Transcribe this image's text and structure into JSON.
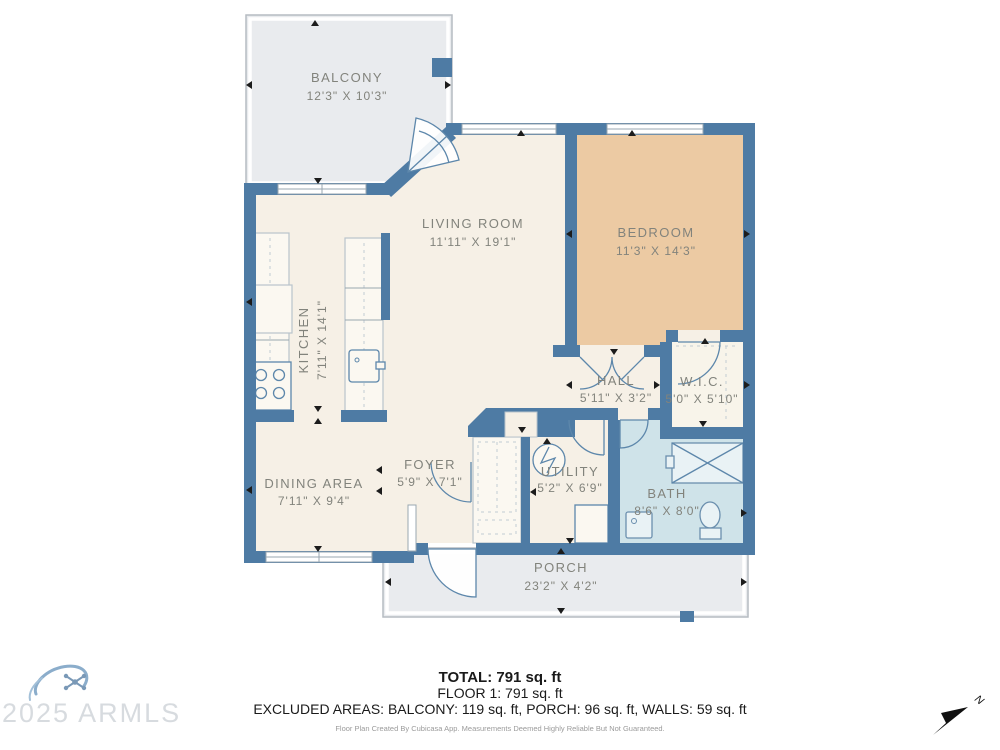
{
  "colors": {
    "wall": "#4e7ba4",
    "floor": "#f6f0e6",
    "bedroom": "#eccaa3",
    "bath": "#cfe3e9",
    "outdoor": "#e9ebee",
    "label": "#82837c"
  },
  "floor_plan": {
    "rooms": [
      {
        "name": "BALCONY",
        "dimensions": "12'3\" X 10'3\""
      },
      {
        "name": "LIVING ROOM",
        "dimensions": "11'11\" X 19'1\""
      },
      {
        "name": "KITCHEN",
        "dimensions": "7'11\" X 14'1\""
      },
      {
        "name": "BEDROOM",
        "dimensions": "11'3\" X 14'3\""
      },
      {
        "name": "HALL",
        "dimensions": "5'11\" X 3'2\""
      },
      {
        "name": "W.I.C.",
        "dimensions": "5'0\" X 5'10\""
      },
      {
        "name": "FOYER",
        "dimensions": "5'9\" X 7'1\""
      },
      {
        "name": "UTILITY",
        "dimensions": "5'2\" X 6'9\""
      },
      {
        "name": "DINING AREA",
        "dimensions": "7'11\" X 9'4\""
      },
      {
        "name": "BATH",
        "dimensions": "8'6\" X 8'0\""
      },
      {
        "name": "PORCH",
        "dimensions": "23'2\" X 4'2\""
      }
    ],
    "summary": {
      "total": "TOTAL: 791 sq. ft",
      "floor": "FLOOR 1: 791 sq. ft",
      "excluded": "EXCLUDED AREAS: BALCONY: 119 sq. ft, PORCH: 96 sq. ft, WALLS: 59 sq. ft",
      "disclaimer": "Floor Plan Created By Cubicasa App. Measurements Deemed Highly Reliable But Not Guaranteed."
    },
    "watermark": "2025 ARMLS",
    "compass_label": "N"
  }
}
